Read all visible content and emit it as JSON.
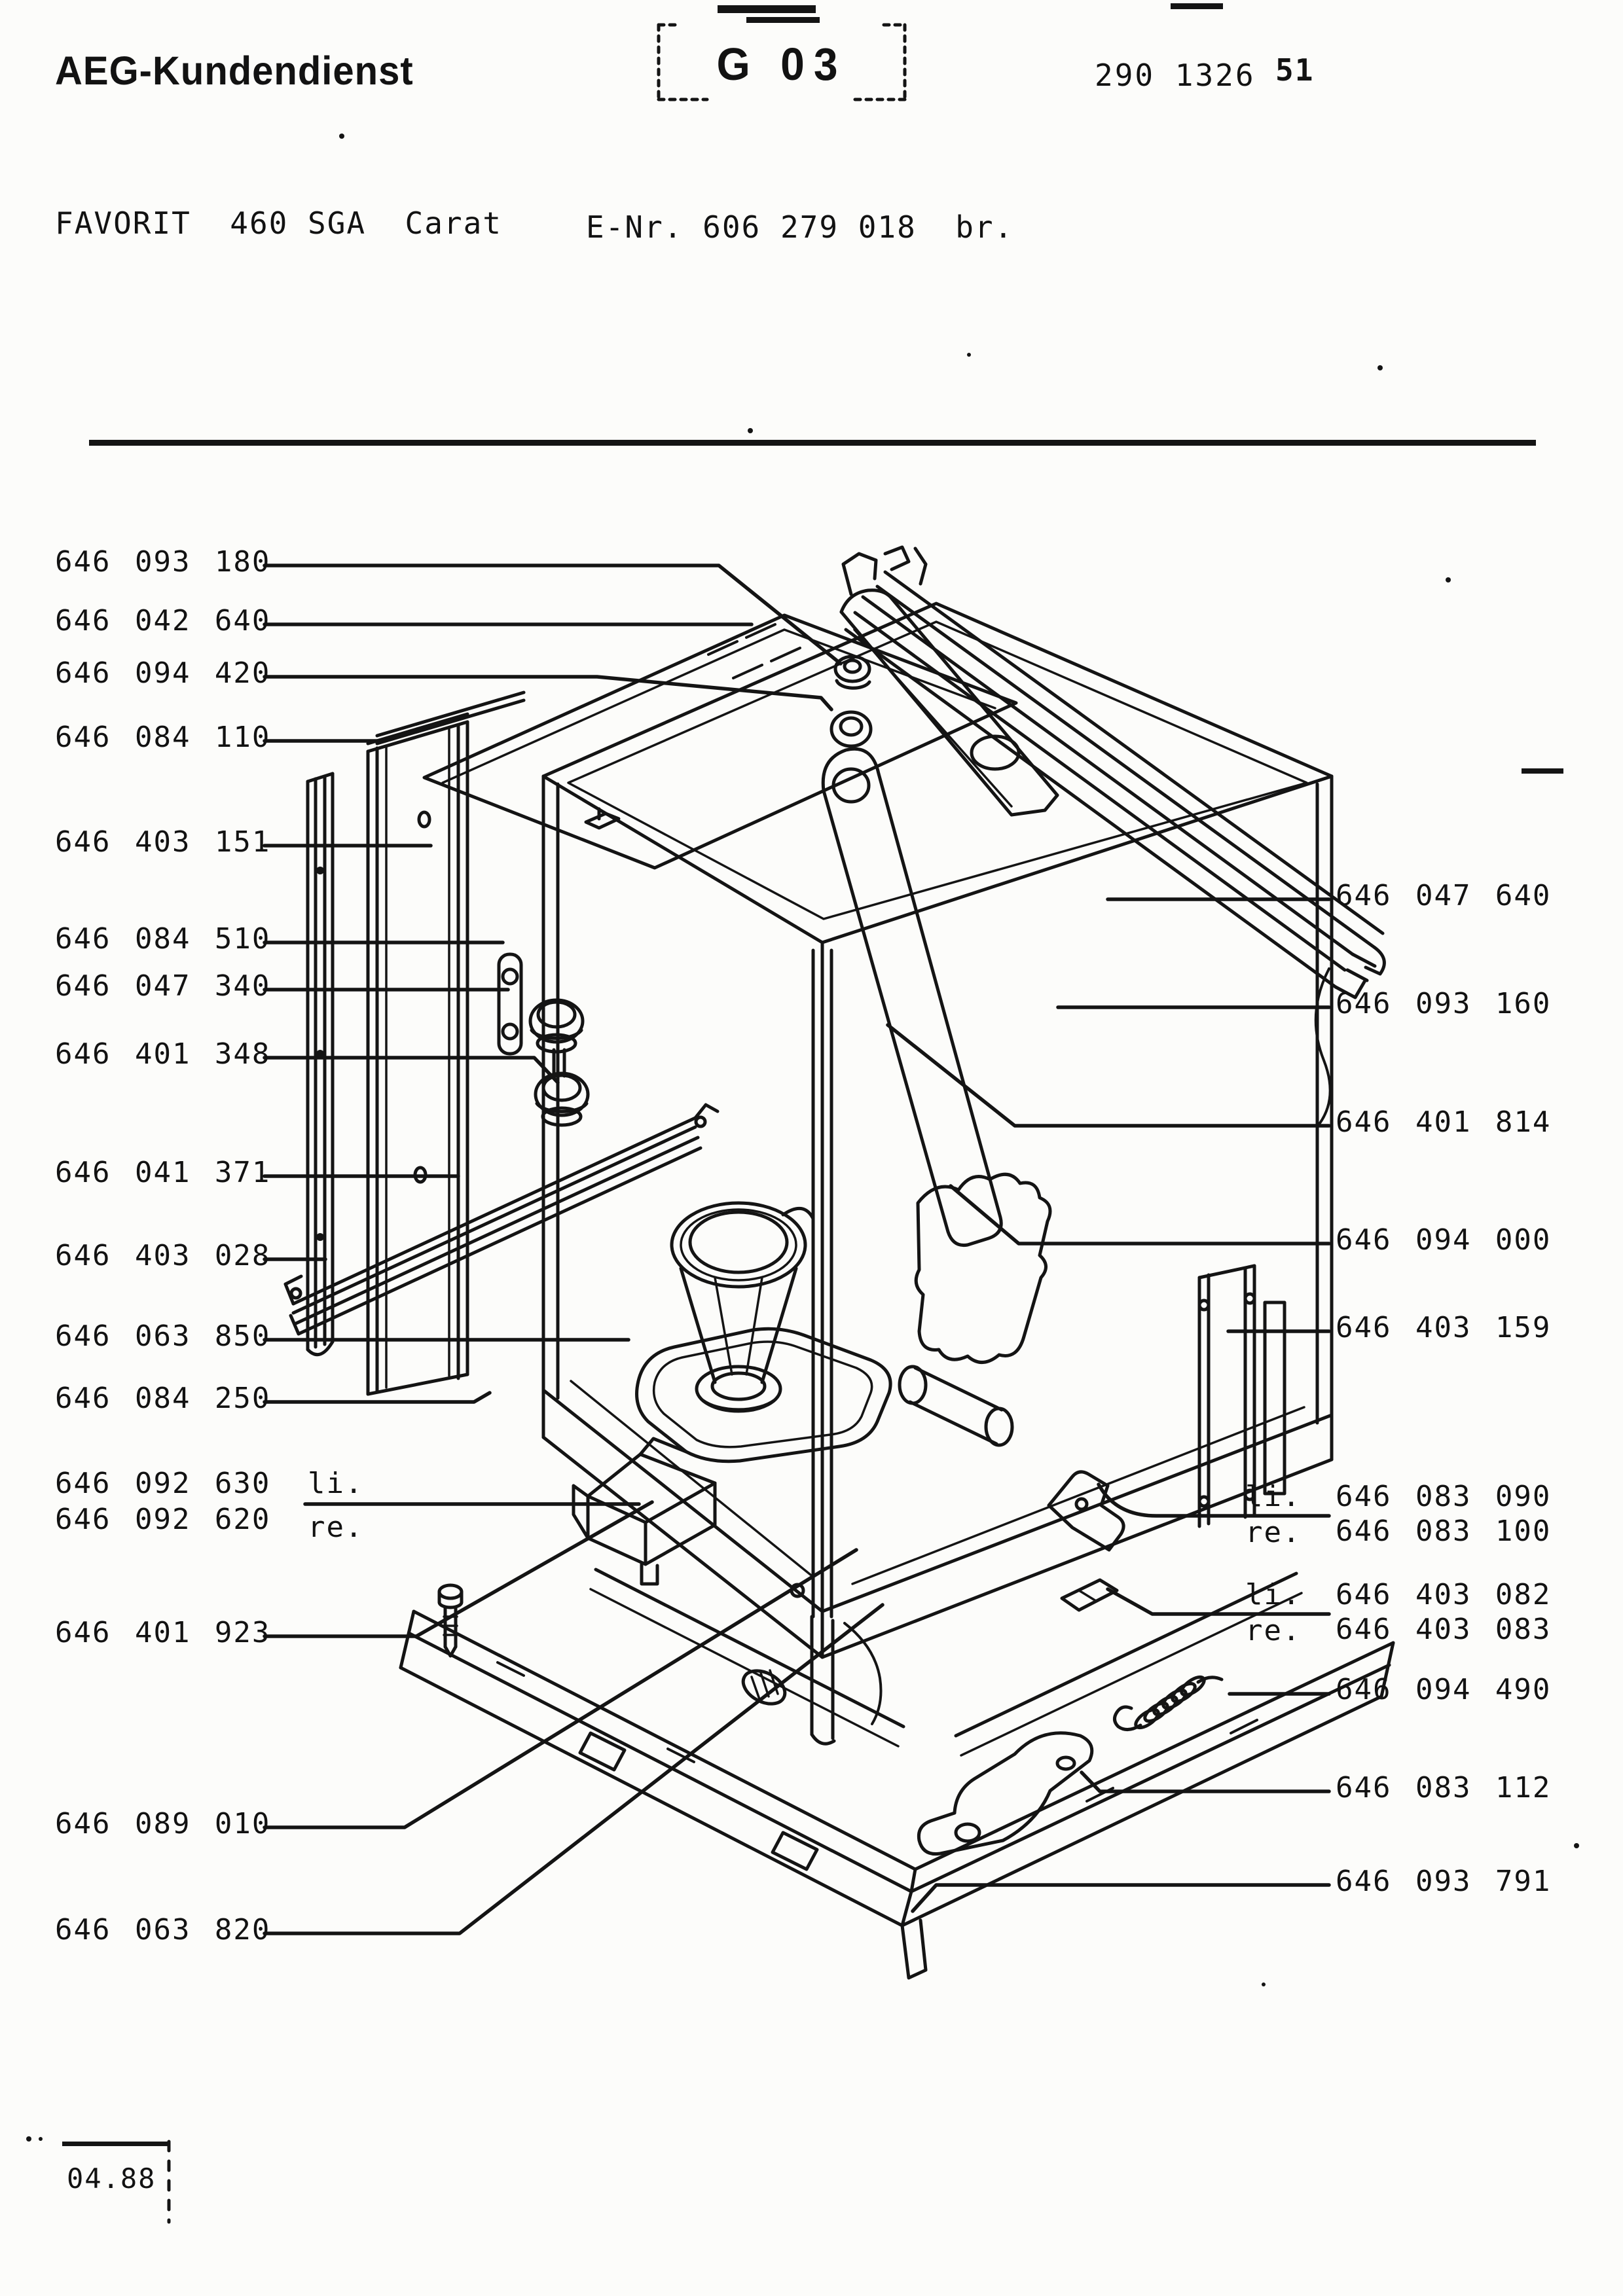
{
  "header": {
    "brand": "AEG-Kundendienst",
    "section_code": "G 03",
    "doc_number": "290 1326",
    "sheet_number": "51",
    "model": "FAVORIT  460 SGA  Carat",
    "enr": "E-Nr. 606 279 018  br."
  },
  "footer": {
    "date_code": "04.88"
  },
  "diagram": {
    "description": "Exploded view of dishwasher tub assembly",
    "ink_color": "#141414"
  },
  "parts_left": [
    {
      "number": "646 093 180"
    },
    {
      "number": "646 042 640"
    },
    {
      "number": "646 094 420"
    },
    {
      "number": "646 084 110"
    },
    {
      "number": "646 403 151"
    },
    {
      "number": "646 084 510"
    },
    {
      "number": "646 047 340"
    },
    {
      "number": "646 401 348"
    },
    {
      "number": "646 041 371"
    },
    {
      "number": "646 403 028"
    },
    {
      "number": "646 063 850"
    },
    {
      "number": "646 084 250"
    },
    {
      "number": "646 092 630",
      "prefix": "li."
    },
    {
      "number": "646 092 620",
      "prefix": "re."
    },
    {
      "number": "646 401 923"
    },
    {
      "number": "646 089 010"
    },
    {
      "number": "646 063 820"
    }
  ],
  "parts_right": [
    {
      "number": "646 047 640"
    },
    {
      "number": "646 093 160"
    },
    {
      "number": "646 401 814"
    },
    {
      "number": "646 094 000"
    },
    {
      "number": "646 403 159"
    },
    {
      "number": "646 083 090",
      "prefix": "li."
    },
    {
      "number": "646 083 100",
      "prefix": "re."
    },
    {
      "number": "646 403 082",
      "prefix": "li."
    },
    {
      "number": "646 403 083",
      "prefix": "re."
    },
    {
      "number": "646 094 490"
    },
    {
      "number": "646 083 112"
    },
    {
      "number": "646 093 791"
    }
  ]
}
